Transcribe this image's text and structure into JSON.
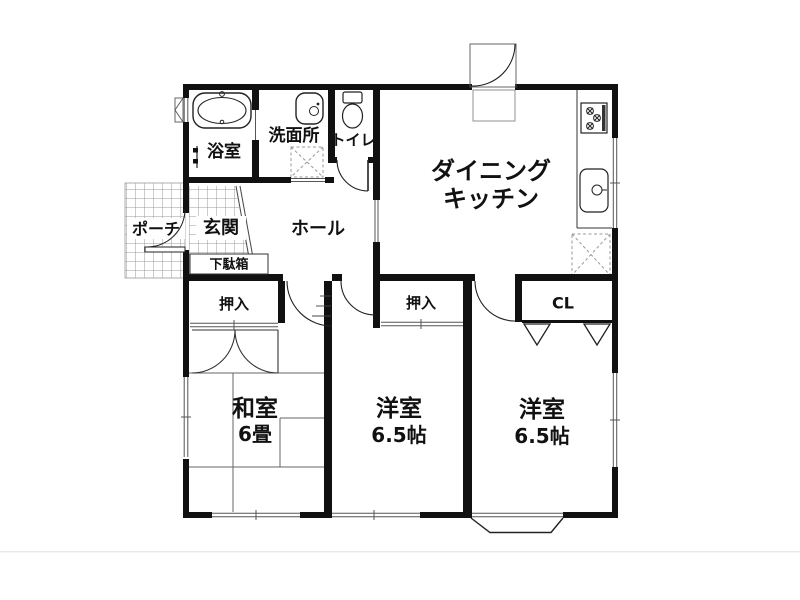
{
  "floorplan": {
    "rooms": {
      "bath": {
        "label": "浴室"
      },
      "washroom": {
        "label": "洗面所"
      },
      "toilet": {
        "label": "トイレ"
      },
      "dining_kitchen": {
        "label_line1": "ダイニング",
        "label_line2": "キッチン"
      },
      "porch": {
        "label": "ポーチ"
      },
      "entry": {
        "label": "玄関"
      },
      "hall": {
        "label": "ホール"
      },
      "shoe_cabinet": {
        "label": "下駄箱"
      },
      "closet_washitsu": {
        "label": "押入"
      },
      "closet_center": {
        "label": "押入"
      },
      "closet_cl": {
        "label": "CL"
      },
      "washitsu": {
        "label": "和室",
        "size": "6畳"
      },
      "youshitsu_center": {
        "label": "洋室",
        "size": "6.5帖"
      },
      "youshitsu_right": {
        "label": "洋室",
        "size": "6.5帖"
      }
    },
    "palette": {
      "background": "#ffffff",
      "wall": "#111111",
      "thin_line": "#333333",
      "tile_grid": "#999999",
      "dashed_fixture": "#999999"
    }
  }
}
